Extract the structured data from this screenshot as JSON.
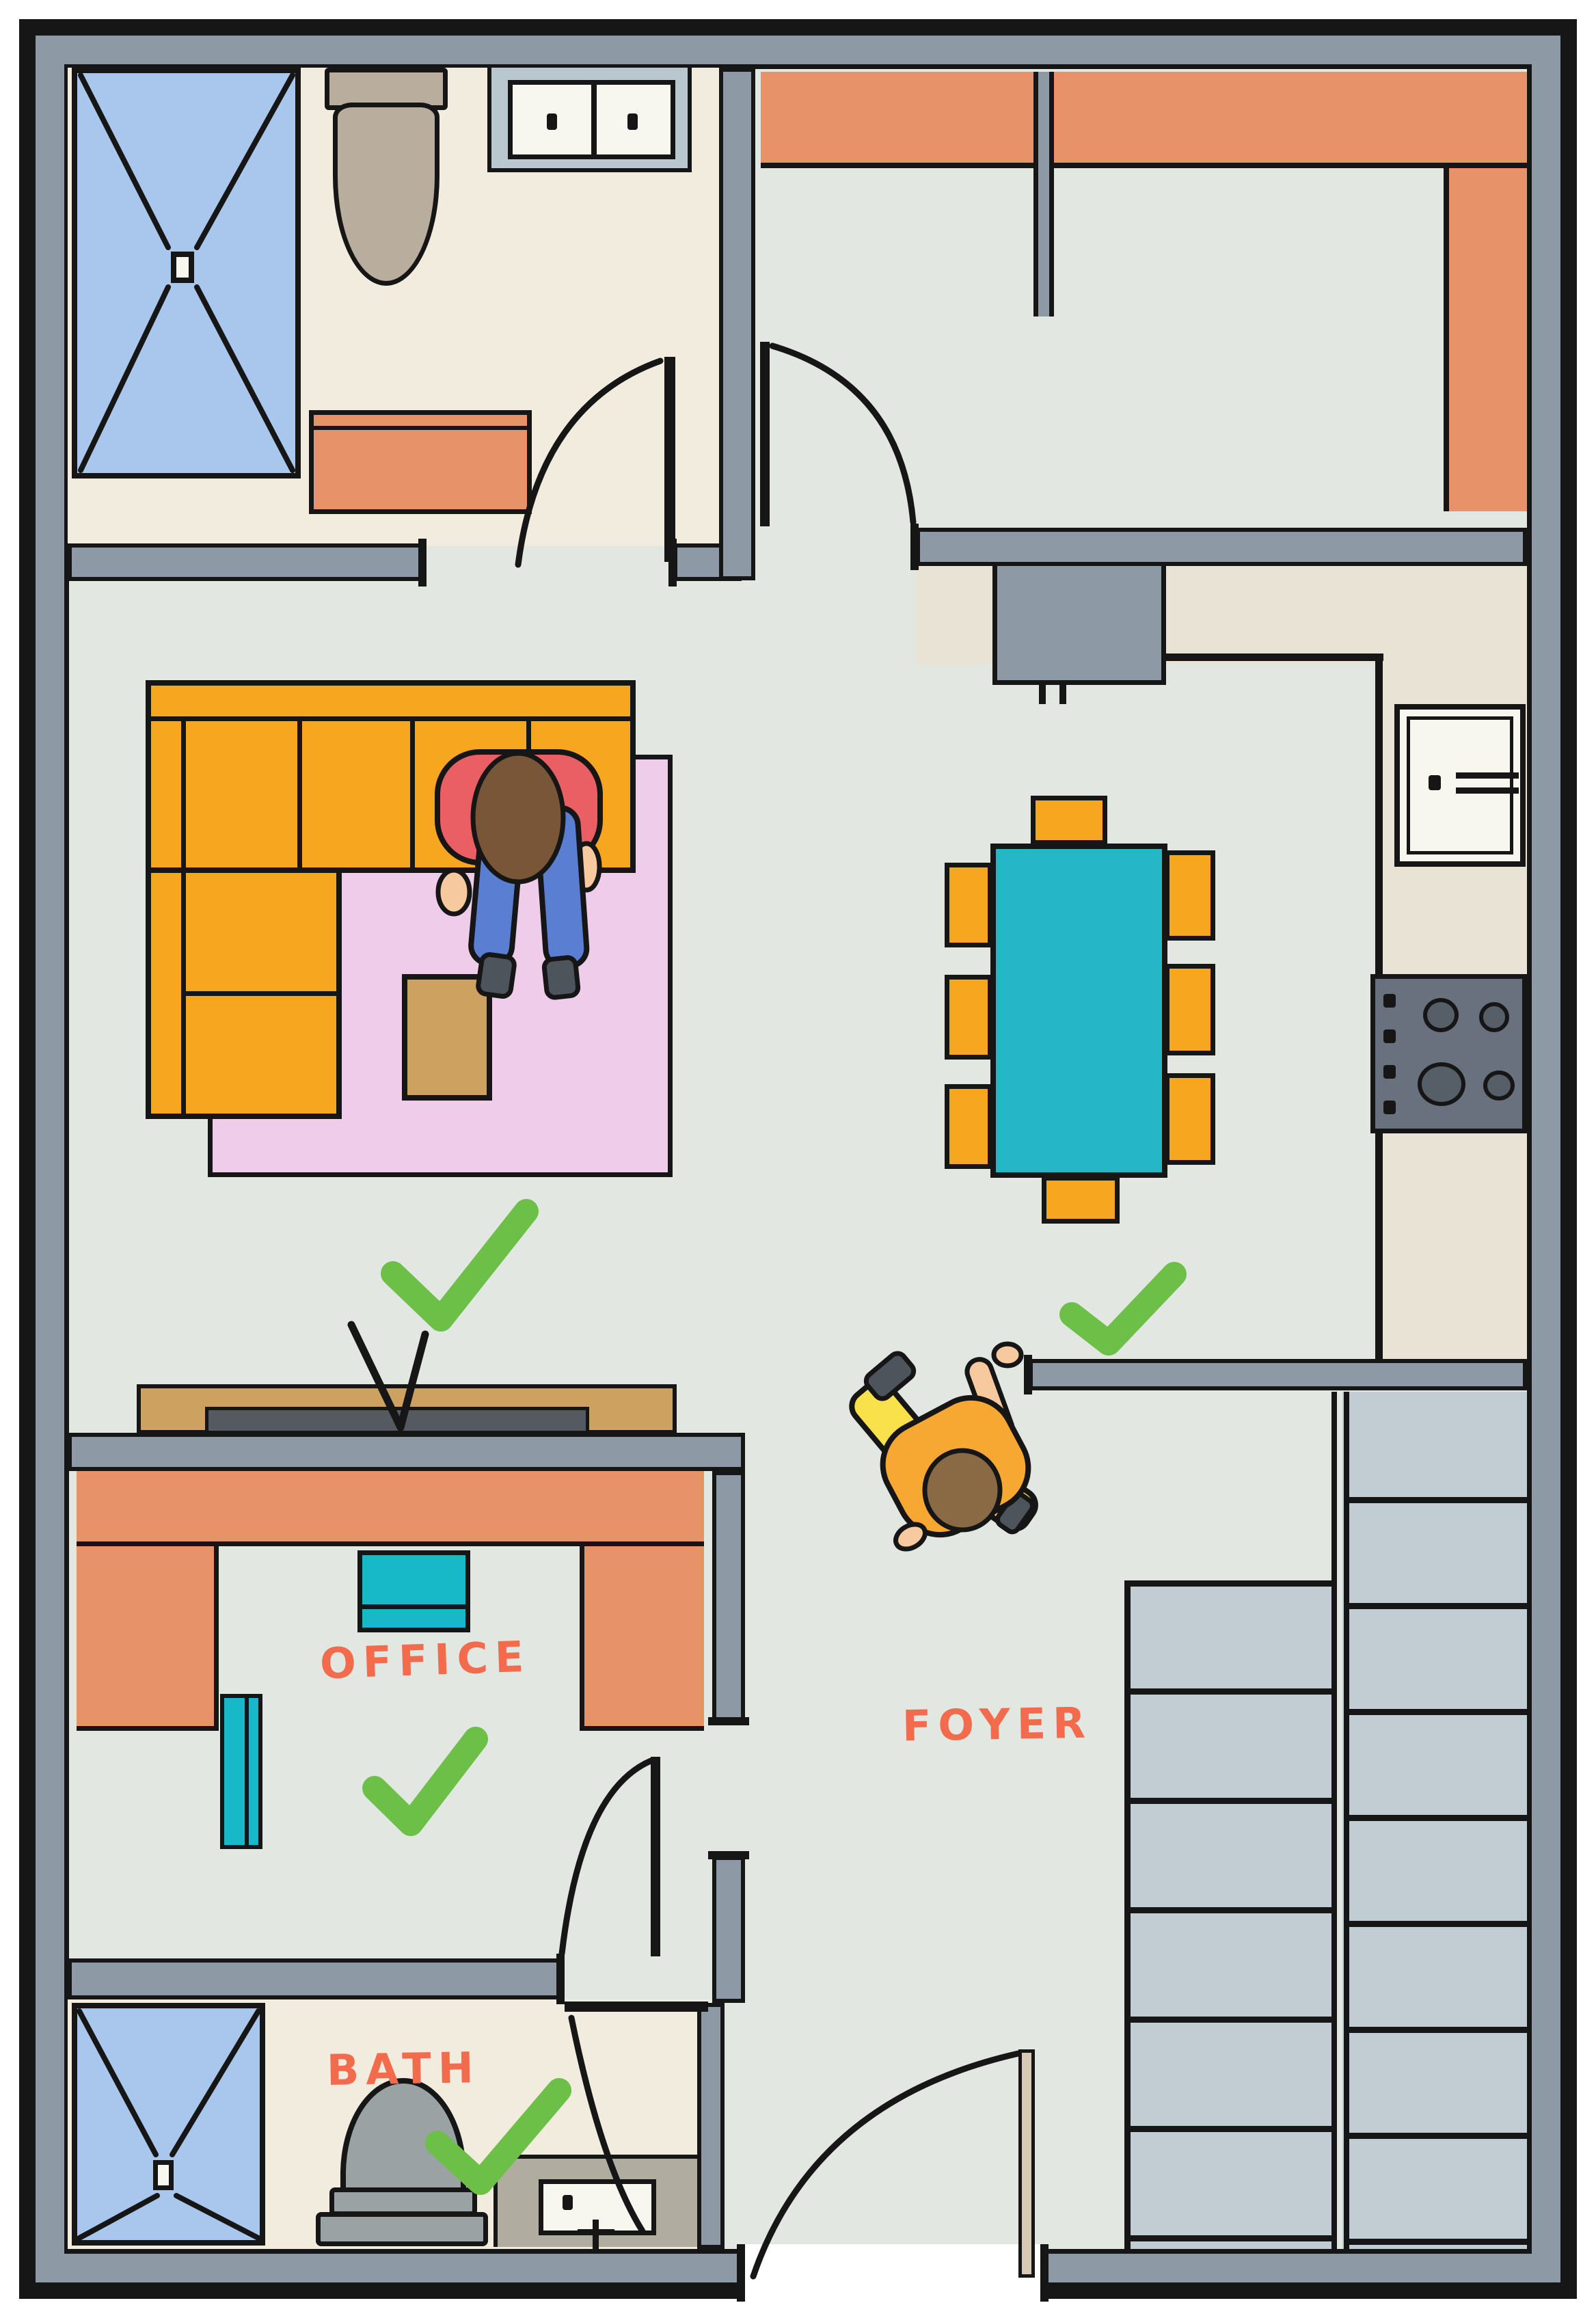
{
  "title": "Hand-drawn apartment floor plan with approved room checkmarks",
  "rooms": {
    "office": {
      "label": "OFFICE",
      "approved": true
    },
    "bath": {
      "label": "BATH",
      "approved": true
    },
    "foyer": {
      "label": "FOYER",
      "approved": false
    },
    "living": {
      "label": "",
      "approved": true
    },
    "dining": {
      "label": "",
      "approved": true
    }
  },
  "annotations": {
    "checkmark_count": 4,
    "checkmark_locations": [
      "living-room",
      "dining-foyer",
      "office",
      "bath"
    ]
  },
  "fixtures": [
    "shower",
    "toilet",
    "double-sink-vanity",
    "dresser",
    "wardrobe-closet",
    "refrigerator",
    "kitchen-sink",
    "stove",
    "dining-table",
    "dining-chairs",
    "sectional-sofa",
    "rug",
    "ottoman",
    "tv-console",
    "desk",
    "desk-chairs",
    "staircase",
    "front-door"
  ],
  "people": [
    {
      "where": "sofa",
      "pose": "sitting-leaning-forward",
      "shirt": "red",
      "pants": "blue-jeans"
    },
    {
      "where": "foyer",
      "pose": "walking",
      "shirt": "orange",
      "pants": "yellow"
    }
  ],
  "palette": {
    "ink": "#161616",
    "wall": "#8d99a5",
    "floor": "#e3e7e2",
    "bath-floor": "#f1ecdd",
    "kitchen": "#e9e3d5",
    "stairs": "#c2ccd3",
    "orange": "#e8926a",
    "sofa": "#f7a61f",
    "rug": "#eeccea",
    "teal": "#25b6c7",
    "teal2": "#17b8c8",
    "tan": "#cda15f",
    "shower": "#a9c7ec",
    "toilet-tan": "#b9ae9d",
    "toilet-gray": "#9aa2a4",
    "vanity": "#b9c7cf",
    "vanity2": "#b0aca0",
    "stove": "#68717d",
    "burner": "#565e68",
    "door-tan": "#d6c9b5",
    "label": "#f26b4c",
    "check": "#6cbf47",
    "skin": "#f6c99f",
    "hair1": "#7a5638",
    "hair2": "#8a6a44",
    "shirt1": "#ea5f64",
    "jeans": "#5a7fd2",
    "shirt2": "#f6a832",
    "pants2": "#f8e14b",
    "shoe": "#4e545c",
    "white": "#f7f6ef"
  }
}
